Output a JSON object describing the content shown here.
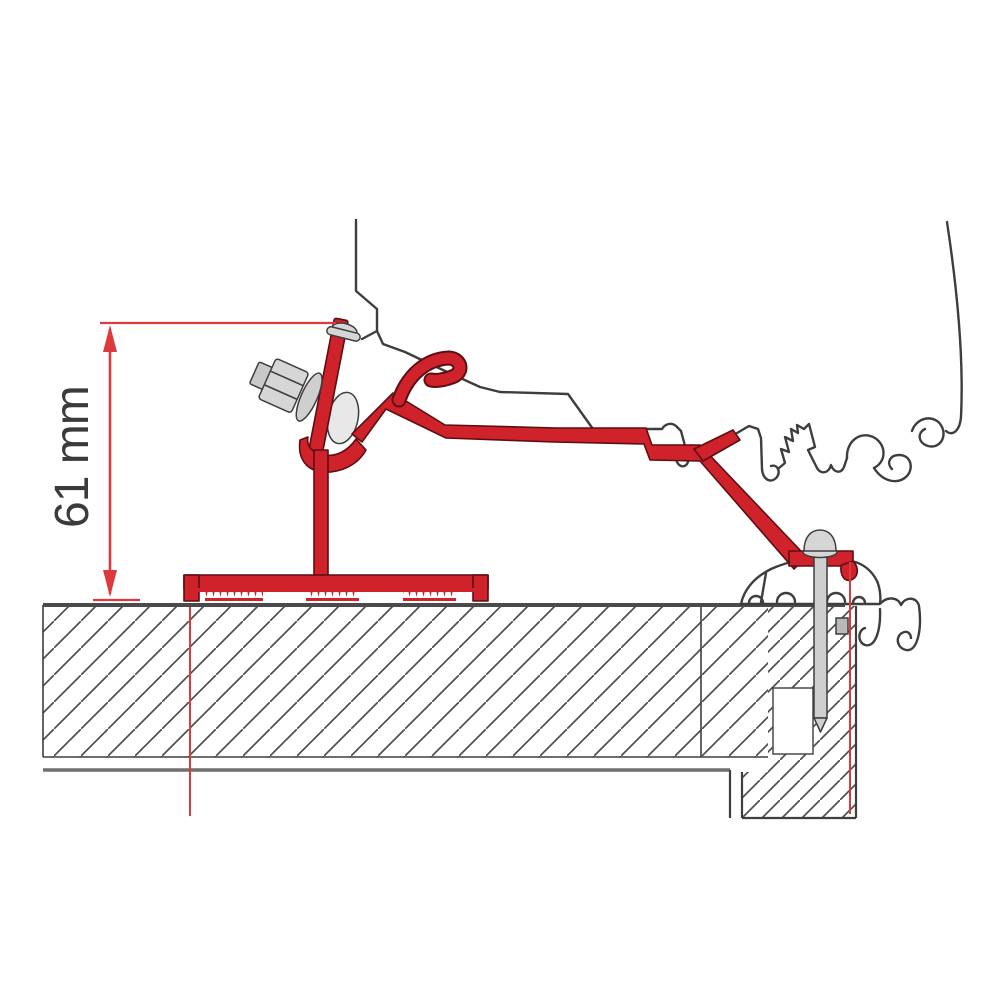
{
  "diagram": {
    "kind": "awning roof-adapter bracket installation cross-section",
    "dimension": {
      "label": "61 mm",
      "value": "61",
      "unit": "mm"
    }
  },
  "colors": {
    "background": "#ffffff",
    "bracket-red": "#d0222a",
    "bracket-outline": "#5d0e12",
    "dimension-red": "#dc3a3e",
    "outline-gray": "#3e3e3e",
    "roof-line": "#4a4a4a",
    "hatch-gray": "#4f4f4f",
    "metal-gray": "#d6d6d6"
  }
}
